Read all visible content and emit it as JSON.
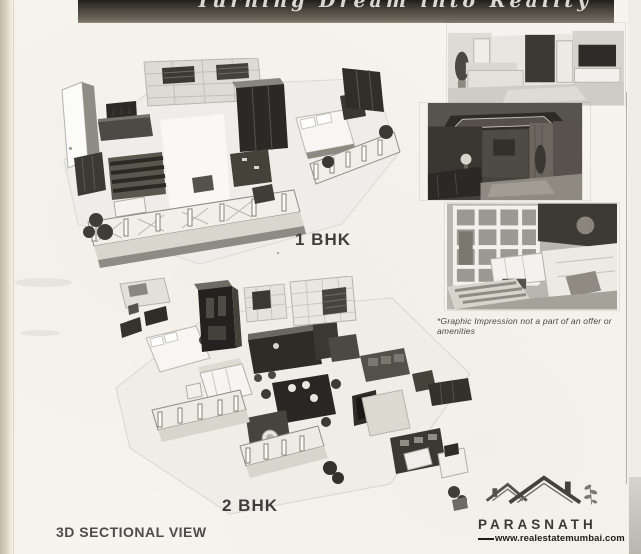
{
  "banner": {
    "tagline": "Turning Dream into Reality"
  },
  "floorplans": {
    "bhk1": {
      "label": "1 BHK"
    },
    "bhk2": {
      "label": "2 BHK"
    },
    "section_label": "3D SECTIONAL VIEW"
  },
  "photo_panel": {
    "disclaimer": "*Graphic Impression not a part of  an offer or amenities"
  },
  "logo": {
    "brand": "PARASNATH",
    "website": "www.realestatemumbai.com"
  },
  "colors": {
    "paper": "#f6f4ee",
    "banner": "#46413a",
    "ink": "#3f3e3c",
    "dark_furniture": "#2b2926",
    "page_edge": "#c3b8a2"
  }
}
